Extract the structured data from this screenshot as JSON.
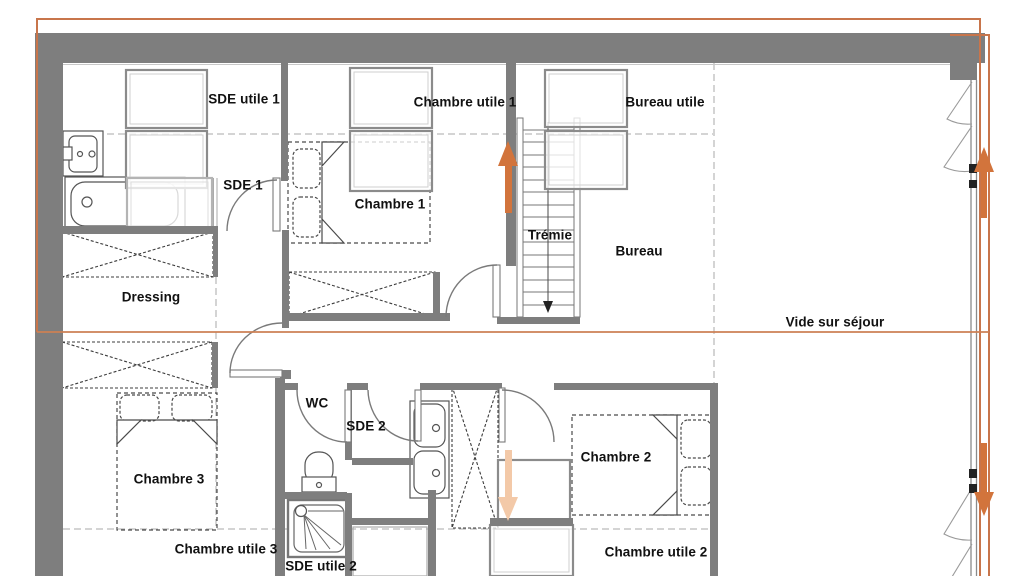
{
  "labels": [
    {
      "id": "sde-utile-1",
      "text": "SDE utile 1"
    },
    {
      "id": "sde-1",
      "text": "SDE 1"
    },
    {
      "id": "chambre-utile-1",
      "text": "Chambre utile 1"
    },
    {
      "id": "chambre-1",
      "text": "Chambre 1"
    },
    {
      "id": "bureau-utile",
      "text": "Bureau utile"
    },
    {
      "id": "tremie",
      "text": "Trémie"
    },
    {
      "id": "bureau",
      "text": "Bureau"
    },
    {
      "id": "dressing",
      "text": "Dressing"
    },
    {
      "id": "vide-sur-sejour",
      "text": "Vide sur séjour"
    },
    {
      "id": "chambre-3",
      "text": "Chambre 3"
    },
    {
      "id": "wc",
      "text": "WC"
    },
    {
      "id": "sde-2",
      "text": "SDE 2"
    },
    {
      "id": "chambre-2",
      "text": "Chambre 2"
    },
    {
      "id": "chambre-utile-3",
      "text": "Chambre utile 3"
    },
    {
      "id": "sde-utile-2",
      "text": "SDE utile 2"
    },
    {
      "id": "chambre-utile-2",
      "text": "Chambre utile 2"
    }
  ],
  "symbols": {
    "stair_direction_arrow": "down",
    "arrows": [
      {
        "name": "stair-up-arrow",
        "direction": "up",
        "color": "#d2743c"
      },
      {
        "name": "facade-up-arrow",
        "direction": "up",
        "color": "#d2743c"
      },
      {
        "name": "facade-down-arrow",
        "direction": "down",
        "color": "#d2743c"
      },
      {
        "name": "room-down-arrow",
        "direction": "down",
        "color": "#f3c9a8"
      }
    ]
  },
  "colors": {
    "wall": "#7e7e7e",
    "plan_outline": "#c8754b",
    "background": "#ffffff",
    "label_text": "#111111"
  }
}
